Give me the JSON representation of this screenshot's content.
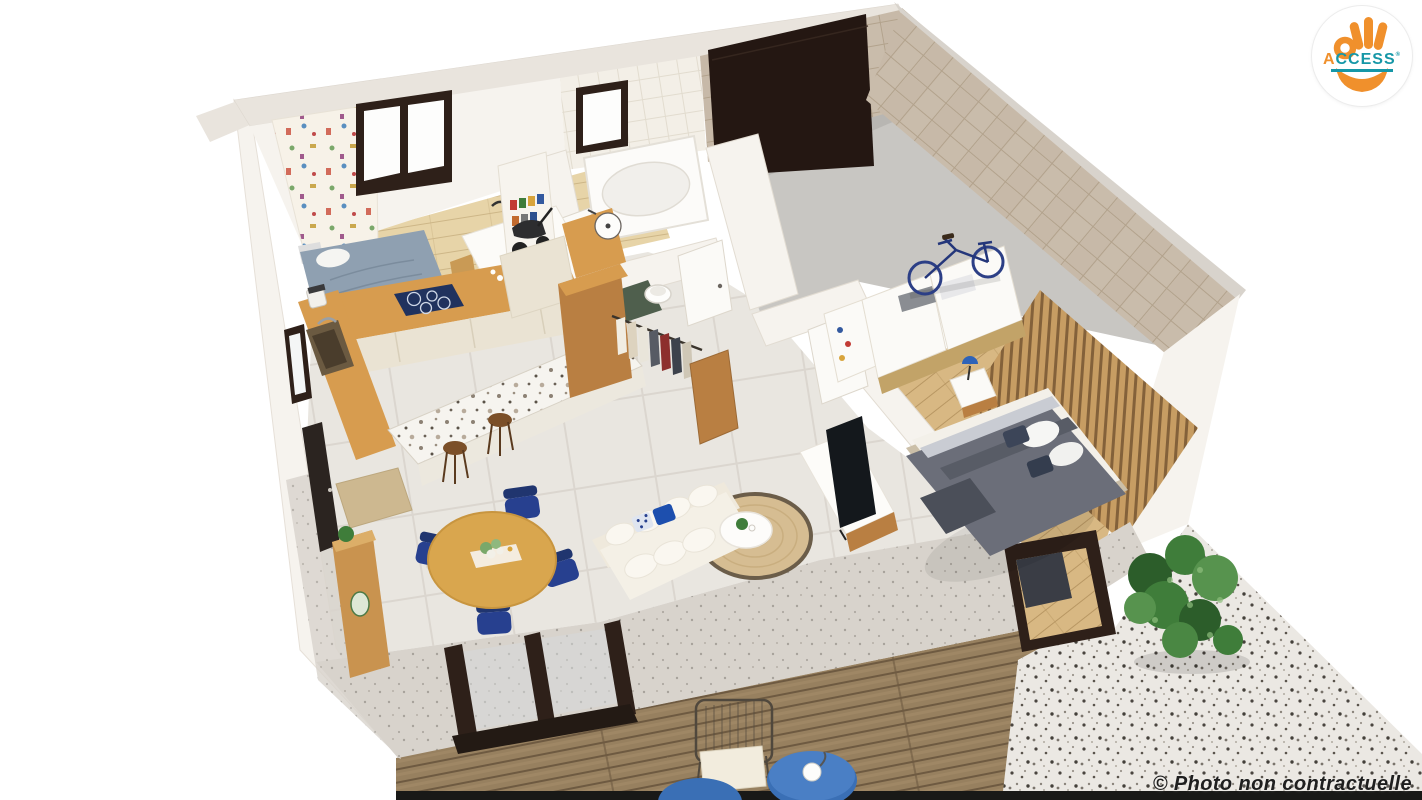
{
  "title": "3D isometric cutaway floor plan render of a single-storey home",
  "overlay": {
    "logo": {
      "text_accent": "A",
      "text_rest": "CCESS",
      "mark": "®",
      "circle_color": "#ffffff",
      "hand_color": "#f0902c",
      "text_color": "#1697a7"
    },
    "watermark": {
      "text": "© Photo non contractuelle",
      "color": "#1f1f1f"
    }
  },
  "palette": {
    "bg": "#ffffff",
    "wall-face": "#f6f3ee",
    "wall-top": "#e9e4dd",
    "wall-cut": "#d8d3cc",
    "travertine": "#c9bcab",
    "travertine-line": "#b2a28c",
    "tile-floor": "#e9e6e0",
    "tile-line": "#dbd6cf",
    "tile-wall": "#f3efe7",
    "wood-floor-light": "#e7d4a8",
    "wood-floor-mid": "#d8b883",
    "wood-counter": "#d79c4f",
    "wood-dark": "#b97f42",
    "cream-cabinet": "#eae3d3",
    "hob-blue": "#20325e",
    "garage-floor": "#c8c6c2",
    "garage-door": "#241712",
    "frame-dark": "#2e2019",
    "deck-wood": "#97805f",
    "deck-line": "#6e5a41",
    "gravel": "#ebe8e3",
    "navy-chair": "#27408f",
    "accent-blue": "#1d4fae",
    "duvet-gray": "#6b6e79",
    "jute": "#d6bd92",
    "jute-ring": "#6b5d49",
    "plant-green": "#3f7d3a",
    "plant-green-dark": "#2c5d2a",
    "sofa-cream": "#f4f0e6",
    "white-furniture": "#fbfaf7",
    "table-side-blue": "#3a6fb5",
    "logo-circle": "#ffffff",
    "logo-orange": "#f0902c",
    "logo-teal": "#1697a7",
    "watermark-color": "#1f1f1f"
  },
  "scene": {
    "view": "isometric-cutaway",
    "rooms": [
      {
        "name": "kids-bedroom",
        "items": [
          "single-bed",
          "patterned-wallpaper",
          "window",
          "desk",
          "desk-lamp",
          "chair",
          "books"
        ]
      },
      {
        "name": "kitchen",
        "items": [
          "l-shaped-wood-counter",
          "induction-hob",
          "sink",
          "coffee-machine",
          "cream-cabinets",
          "terrazzo-island",
          "bar-stools"
        ]
      },
      {
        "name": "bathroom",
        "items": [
          "bathtub",
          "round-basin",
          "wood-vanity",
          "window",
          "tiled-wall"
        ]
      },
      {
        "name": "wc",
        "items": [
          "toilet",
          "green-mat"
        ]
      },
      {
        "name": "dressing",
        "items": [
          "wood-wardrobe",
          "hanging-clothes",
          "open-wood-door"
        ]
      },
      {
        "name": "hallway",
        "items": [
          "white-doors"
        ]
      },
      {
        "name": "laundry-nook",
        "items": [
          "shelving",
          "stroller"
        ]
      },
      {
        "name": "garage",
        "items": [
          "dark-sectional-door",
          "travertine-walls",
          "concrete-floor",
          "blue-bicycle"
        ]
      },
      {
        "name": "master-bedroom",
        "items": [
          "double-bed",
          "gray-duvet",
          "navy-pillows",
          "wood-slat-wall",
          "nightstand",
          "blue-lamp",
          "wardrobes",
          "folded-towels"
        ]
      },
      {
        "name": "living-room",
        "items": [
          "corner-sofa",
          "blue-cushions",
          "round-jute-rug",
          "coffee-table",
          "tv-unit",
          "tv"
        ]
      },
      {
        "name": "dining-area",
        "items": [
          "round-wood-table",
          "navy-chairs",
          "flower-centerpiece",
          "sideboard",
          "doormat",
          "entry-door"
        ]
      },
      {
        "name": "terrace",
        "items": [
          "wood-deck",
          "wire-chair",
          "blue-side-tables",
          "bay-windows"
        ]
      },
      {
        "name": "garden",
        "items": [
          "gravel-terrazzo-path",
          "green-bush"
        ]
      }
    ]
  }
}
